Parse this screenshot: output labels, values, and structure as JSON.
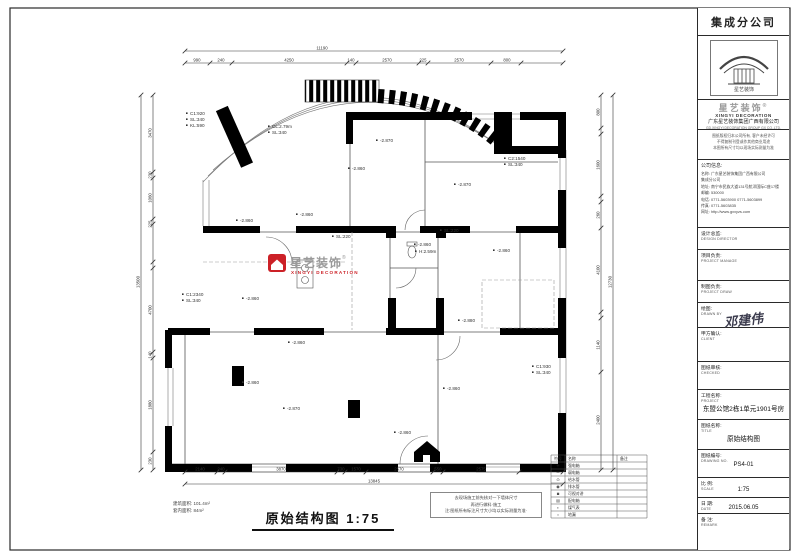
{
  "page": {
    "frame_color": "#2a2a2a",
    "accent_red": "#cc2127"
  },
  "plan": {
    "title": "原始结构图 1:75",
    "area_lines": [
      "建筑面积: 101.4m²",
      "套内面积: 84m²"
    ],
    "note_lines": [
      "去现场施工前先核对一下墙体尺寸",
      "再进行做料·施工",
      "注:图纸所有标注尺寸大小均以实际测量为准·"
    ],
    "watermark": {
      "brand_cn": "星艺装饰",
      "reg": "®",
      "brand_en": "XINGYI DECORATION"
    },
    "annotations": [
      {
        "x": 352,
        "y": 170,
        "t": "-2.860"
      },
      {
        "x": 380,
        "y": 142,
        "t": "-2.870"
      },
      {
        "x": 458,
        "y": 186,
        "t": "-2.870"
      },
      {
        "x": 300,
        "y": 216,
        "t": "-2.860"
      },
      {
        "x": 240,
        "y": 222,
        "t": "-2.860"
      },
      {
        "x": 418,
        "y": 246,
        "t": "-2.860"
      },
      {
        "x": 419,
        "y": 253,
        "t": "H:2.59m"
      },
      {
        "x": 497,
        "y": 252,
        "t": "-2.860"
      },
      {
        "x": 246,
        "y": 300,
        "t": "-2.860"
      },
      {
        "x": 292,
        "y": 344,
        "t": "-2.860"
      },
      {
        "x": 462,
        "y": 322,
        "t": "-2.880"
      },
      {
        "x": 246,
        "y": 384,
        "t": "-2.860"
      },
      {
        "x": 287,
        "y": 410,
        "t": "-2.870"
      },
      {
        "x": 447,
        "y": 390,
        "t": "-2.860"
      },
      {
        "x": 398,
        "y": 434,
        "t": "-2.860"
      },
      {
        "x": 272,
        "y": 128,
        "t": "CL:2.79m"
      },
      {
        "x": 272,
        "y": 134,
        "t": "SL:340"
      },
      {
        "x": 190,
        "y": 115,
        "t": "C1:920"
      },
      {
        "x": 190,
        "y": 121,
        "t": "SL:340"
      },
      {
        "x": 190,
        "y": 127,
        "t": "KL:590"
      },
      {
        "x": 186,
        "y": 296,
        "t": "C1:2340"
      },
      {
        "x": 186,
        "y": 302,
        "t": "SL:340"
      },
      {
        "x": 536,
        "y": 368,
        "t": "C1:930"
      },
      {
        "x": 536,
        "y": 374,
        "t": "SL:340"
      },
      {
        "x": 444,
        "y": 232,
        "t": "SL:220"
      },
      {
        "x": 336,
        "y": 238,
        "t": "SL:220"
      },
      {
        "x": 508,
        "y": 160,
        "t": "C2:1540"
      },
      {
        "x": 508,
        "y": 166,
        "t": "SL:340"
      }
    ],
    "dims": {
      "h": [
        {
          "y": 51,
          "x1": 185,
          "x2": 563,
          "ticks": [
            185,
            563
          ],
          "labels": [
            {
              "x": 322,
              "t": "11190"
            }
          ]
        },
        {
          "y": 63,
          "x1": 185,
          "x2": 563,
          "ticks": [
            185,
            210,
            232,
            347,
            356,
            419,
            428,
            491,
            521,
            563
          ],
          "labels": [
            {
              "x": 197,
              "t": "990"
            },
            {
              "x": 221,
              "t": "240"
            },
            {
              "x": 289,
              "t": "4250"
            },
            {
              "x": 351,
              "t": "140"
            },
            {
              "x": 387,
              "t": "2570"
            },
            {
              "x": 423,
              "t": "225"
            },
            {
              "x": 459,
              "t": "2570"
            },
            {
              "x": 507,
              "t": "800"
            }
          ]
        },
        {
          "y": 472,
          "x1": 185,
          "x2": 563,
          "ticks": [
            185,
            217,
            225,
            337,
            345,
            366,
            433,
            443,
            519,
            563
          ],
          "labels": [
            {
              "x": 200,
              "t": "2140"
            },
            {
              "x": 221,
              "t": "240"
            },
            {
              "x": 281,
              "t": "3870"
            },
            {
              "x": 341,
              "t": "730"
            },
            {
              "x": 356,
              "t": "1570"
            },
            {
              "x": 399,
              "t": "2570"
            },
            {
              "x": 438,
              "t": "550"
            },
            {
              "x": 481,
              "t": "2575"
            }
          ]
        },
        {
          "y": 484,
          "x1": 185,
          "x2": 563,
          "ticks": [
            185,
            563
          ],
          "labels": [
            {
              "x": 374,
              "t": "13845"
            }
          ]
        }
      ],
      "v": [
        {
          "x": 141,
          "y1": 95,
          "y2": 470,
          "ticks": [
            95,
            470
          ],
          "labels": [
            {
              "y": 282,
              "t": "13500"
            }
          ]
        },
        {
          "x": 153,
          "y1": 95,
          "y2": 470,
          "ticks": [
            95,
            172,
            178,
            219,
            224,
            262,
            268,
            352,
            358,
            452,
            470
          ],
          "labels": [
            {
              "y": 133,
              "t": "3470"
            },
            {
              "y": 175,
              "t": "230"
            },
            {
              "y": 198,
              "t": "1060"
            },
            {
              "y": 224,
              "t": "225"
            },
            {
              "y": 310,
              "t": "4700"
            },
            {
              "y": 355,
              "t": "140"
            },
            {
              "y": 405,
              "t": "1880"
            },
            {
              "y": 461,
              "t": "230"
            }
          ]
        },
        {
          "x": 601,
          "y1": 95,
          "y2": 470,
          "ticks": [
            95,
            128,
            134,
            196,
            202,
            228,
            312,
            318,
            372,
            470
          ],
          "labels": [
            {
              "y": 112,
              "t": "800"
            },
            {
              "y": 165,
              "t": "1600"
            },
            {
              "y": 215,
              "t": "260"
            },
            {
              "y": 270,
              "t": "4100"
            },
            {
              "y": 345,
              "t": "1140"
            },
            {
              "y": 420,
              "t": "2400"
            }
          ]
        },
        {
          "x": 613,
          "y1": 95,
          "y2": 470,
          "ticks": [
            95,
            470
          ],
          "labels": [
            {
              "y": 282,
              "t": "12730"
            }
          ]
        }
      ]
    },
    "legend": {
      "rows": [
        [
          "符号",
          "名称",
          "备注"
        ],
        [
          "＋",
          "强电箱",
          ""
        ],
        [
          "－",
          "弱电箱",
          ""
        ],
        [
          "⊙",
          "给水管",
          ""
        ],
        [
          "◉",
          "排水管",
          ""
        ],
        [
          "◙",
          "可视对讲",
          ""
        ],
        [
          "▤",
          "配电箱",
          ""
        ],
        [
          "▪",
          "煤气表",
          ""
        ],
        [
          "○",
          "地漏",
          ""
        ]
      ]
    }
  },
  "titleblock": {
    "company_header": "集成分公司",
    "logo_caption": "星艺装饰",
    "brand_cn": "星艺装饰",
    "brand_reg": "®",
    "brand_en": "XINGYI DECORATION",
    "company_cn": "广东星艺装饰集团广西有限公司",
    "company_en": "GD.XINGYI DECORATION GROUP GX CO.,LTD.",
    "disclaimer_lines": [
      "图纸版权归本公司所有, 客户未经许可",
      "不得复制刊登或作其他商业用途",
      "本图所有尺寸均以现场实际测量为准"
    ],
    "info_header": "公司信息:",
    "info_lines": [
      "名称: 广东星艺装饰集团广西有限公司",
      "         集成分公司",
      "地址: 南宁市民族大道131号航洋国际C座17楼",
      "邮编: 530000",
      "电话: 0771-5603900  0771-5603899",
      "传真: 0771-5603835",
      "网址: http://www.gxxyzs.com"
    ],
    "fields": [
      {
        "key": "design-director",
        "label": "设计总监:",
        "en": "DESIGN DIRECTOR",
        "value": ""
      },
      {
        "key": "project-manager",
        "label": "项目负责:",
        "en": "PROJECT MANAGE",
        "value": ""
      },
      {
        "key": "project-draw",
        "label": "制图负责:",
        "en": "PROJECT DRAW",
        "value": ""
      },
      {
        "key": "drawn-by",
        "label": "绘图:",
        "en": "DRAWN BY",
        "value": "邓建伟",
        "script": true
      },
      {
        "key": "client",
        "label": "甲方确认:",
        "en": "CLIENT",
        "value": ""
      },
      {
        "key": "checked",
        "label": "图纸审核:",
        "en": "CHECKED",
        "value": ""
      },
      {
        "key": "project-name",
        "label": "工程名称:",
        "en": "PROJECT",
        "value": "东盟公馆2栋1单元1901号房",
        "big": true
      },
      {
        "key": "drawing-title",
        "label": "图纸名称:",
        "en": "TITLE",
        "value": "原始结构图",
        "big": true
      },
      {
        "key": "drawing-no",
        "label": "图纸编号:",
        "en": "DRAWING NO.",
        "value": "PS4-01"
      },
      {
        "key": "scale",
        "label": "比 例:",
        "en": "SCALE",
        "value": "1:75"
      },
      {
        "key": "date",
        "label": "日 期:",
        "en": "DATE",
        "value": "2015.06.05"
      },
      {
        "key": "remark",
        "label": "备 注:",
        "en": "REMARK",
        "value": ""
      }
    ]
  }
}
